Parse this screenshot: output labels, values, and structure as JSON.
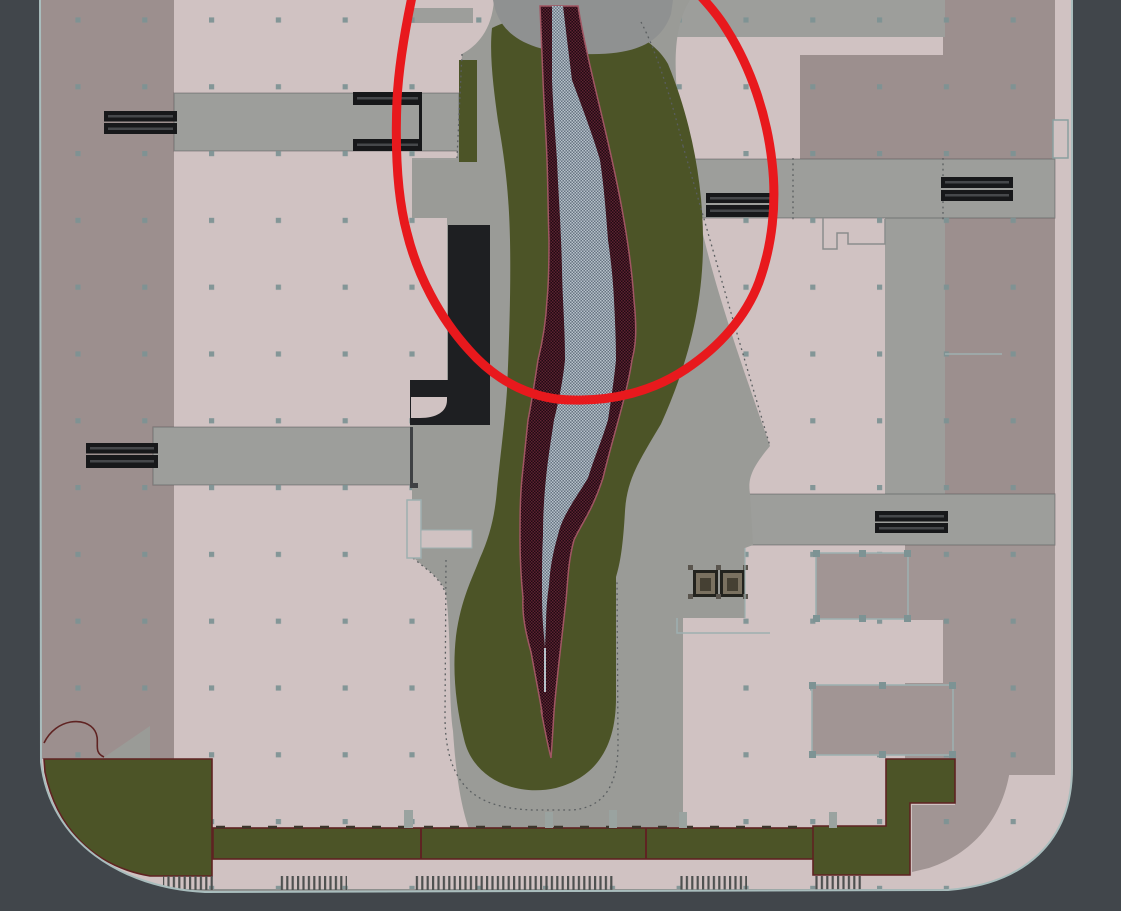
{
  "meta": {
    "content_type": "site-plan-screenshot",
    "description": "Top-down CAD landscape site plan: central park strip with winding crosshatched river, surrounding buildings, roads, bridge markers and paved edges. A freehand red ellipse annotation highlights the upper river corridor.",
    "visible_text": "none"
  },
  "palette": {
    "bg": "#41464b",
    "site": "#d0c2c2",
    "mauve": "#9c8f8e",
    "mauve2": "#a19594",
    "road": "#9d9e9b",
    "park": "#9a9b97",
    "arc": "#8f9191",
    "green": "#4c5427",
    "green_line": "#5f2322",
    "black": "#17181a",
    "bar_stripe": "#46484b",
    "blue_a": "#b7c2cb",
    "blue_b": "#677482",
    "maroon_a": "#5d2331",
    "maroon_b": "#200a13",
    "river_edge": "#a05663",
    "red": "#e8191d",
    "dots": "#7d9394",
    "edge": "#a9bdbd",
    "hatch": "#4e5150",
    "street": "#8d8f8d",
    "outline_light": "#9eb0b0",
    "bench_frame": "#23231e",
    "bench_mid": "#7a7160",
    "bench_core": "#454033",
    "dotted": "#5a5e60",
    "dark_line": "#3f4144",
    "grip": "#5a554e",
    "post": "#9aa3a0"
  },
  "annotation": {
    "shape": "freehand-ellipse",
    "color": "#e8191d",
    "stroke_px": 9,
    "highlights": "upper river corridor of the central park",
    "approx_center": {
      "x": 585,
      "y": 196
    },
    "approx_radius": {
      "x": 188,
      "y": 205
    }
  },
  "features": {
    "river": {
      "water": "blue-gray crosshatch",
      "banks": "maroon crosshatch with pink edge",
      "flows": "north-south, tapers to a point at south end"
    },
    "bridge_markers": 6,
    "railing_marker_pairs": 1,
    "benches": 2,
    "hatched_paving_strips": 5,
    "outlined_plots_with_grips": 2,
    "grid_dot_spacing_px": 67,
    "areas": [
      "buildings",
      "roads",
      "park-path",
      "lawn",
      "river",
      "street",
      "sidewalk"
    ]
  }
}
